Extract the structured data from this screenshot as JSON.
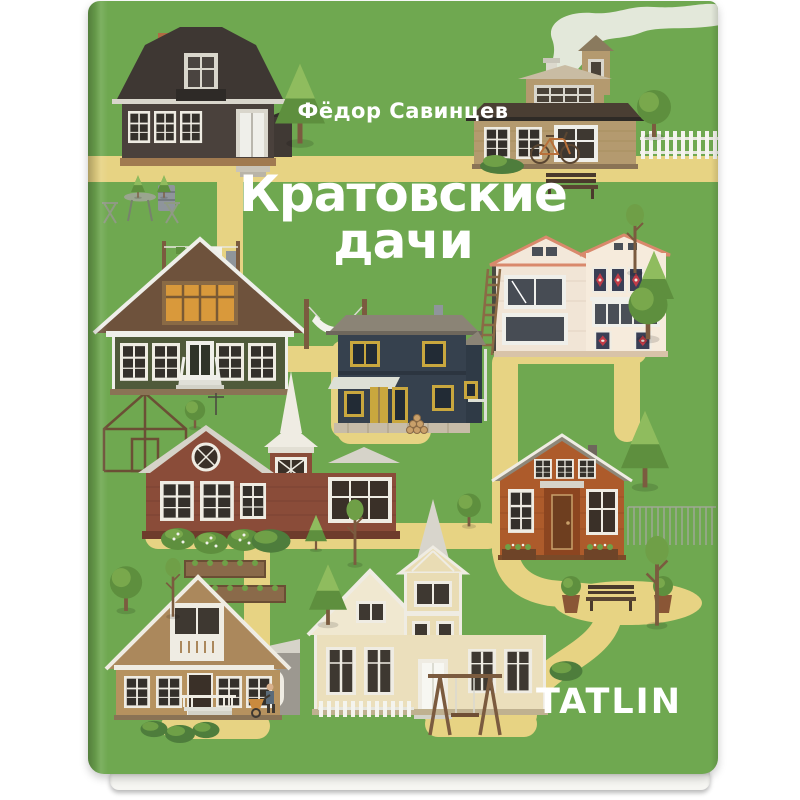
{
  "book": {
    "author": "Фёдор Савинцев",
    "title_line1": "Кратовские",
    "title_line2": "дачи",
    "title_full": "Кратовские дачи",
    "publisher": "TATLIN"
  },
  "colors": {
    "page_bg": "#ffffff",
    "cover_green": "#6FA850",
    "cover_green_dark": "#55933E",
    "path_yellow": "#E7D383",
    "text_white": "#ffffff",
    "pages": "#F6F6F2"
  },
  "illustration": {
    "scene": "flat-illustrated map of a dacha village on a green book cover, houses linked by yellow paths",
    "houses": [
      "dark-brown gambrel-roof dacha with porch, barrel and garden table",
      "tan dacha with smoking chimney, bicycle and white picket fence",
      "green gable dacha with orange attic window, white stairs and hammock",
      "cream two-storey dacha with red stained-glass windows and ladder",
      "navy-blue dacha with yellow doors and grey roof",
      "red-brown dacha with white spire tower and berry bushes",
      "orange dacha with grey gable roof, flower boxes and metal fence",
      "cream dacha with tall white spire, picket fence and swing set",
      "tan gable dacha with grey annexe, gardener, wheelbarrow and garden beds"
    ],
    "props": [
      "clothesline",
      "greenhouse-frame",
      "park-bench",
      "bench-with-planters",
      "swing-set",
      "bicycle",
      "chimney-smoke",
      "trees",
      "bushes"
    ]
  }
}
